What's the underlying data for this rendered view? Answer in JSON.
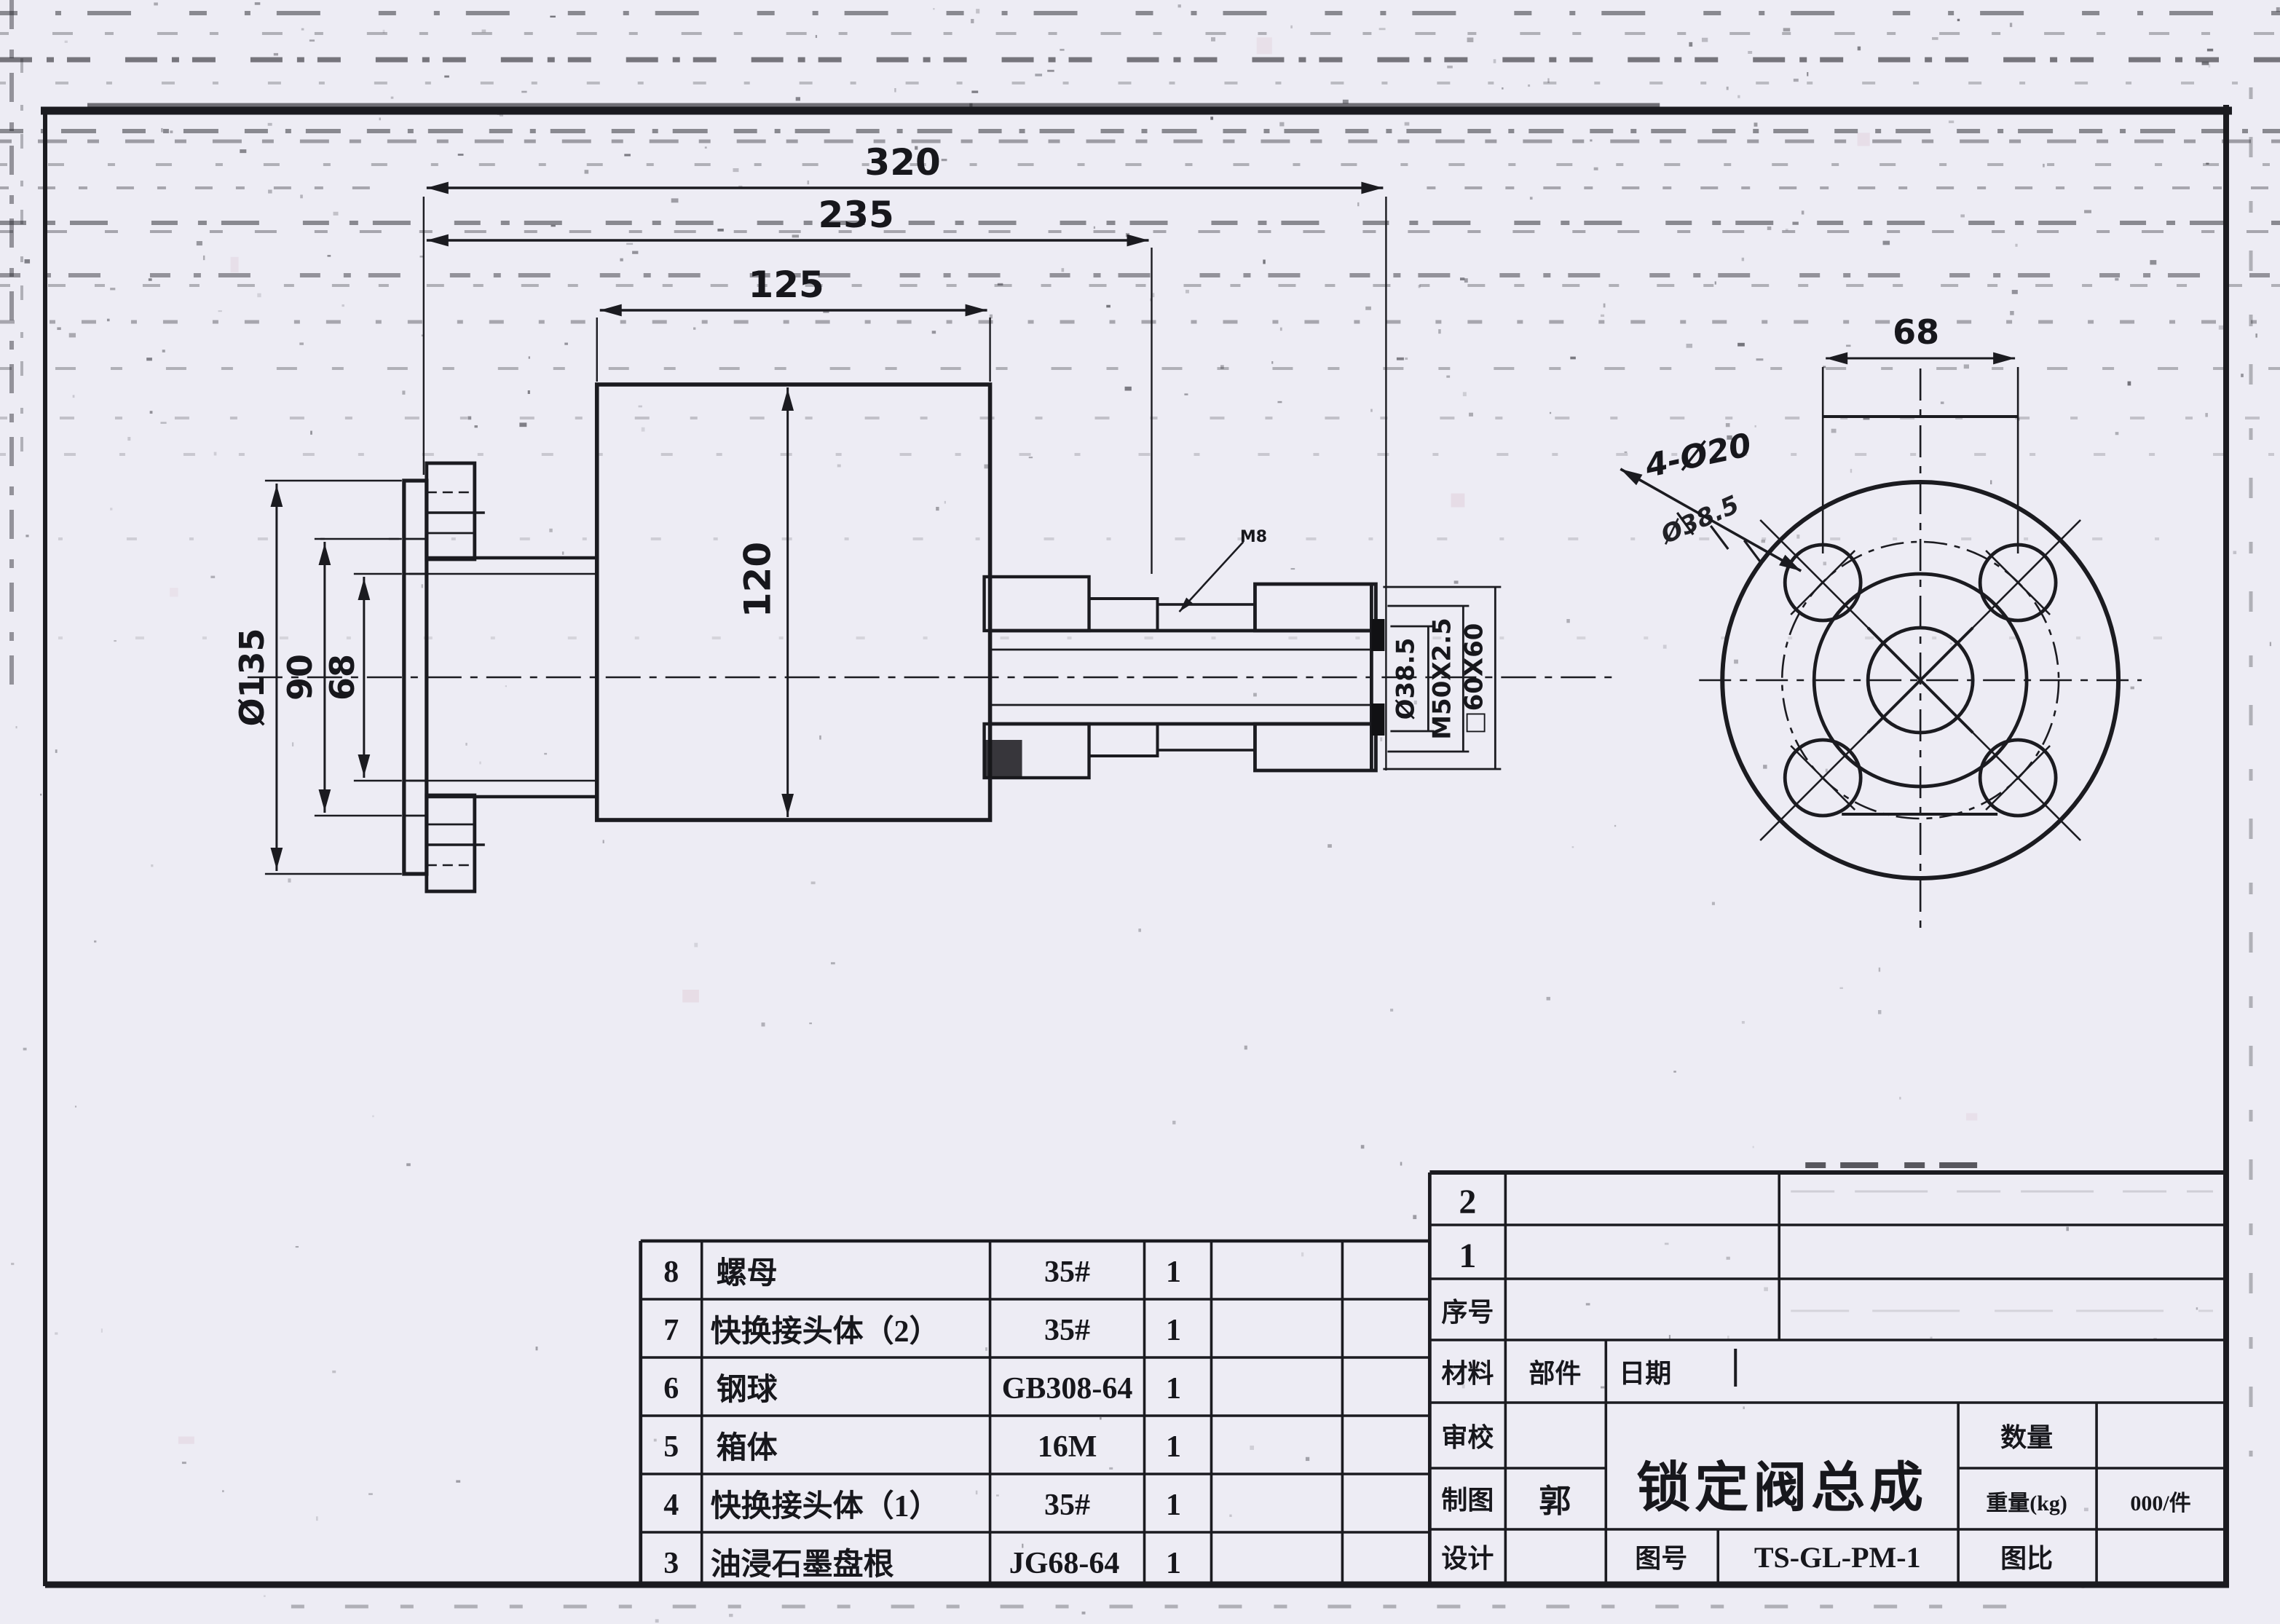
{
  "document": {
    "type": "scanned engineering drawing",
    "language": "zh-CN",
    "ink_color": "#1b1b20",
    "paper_color": "#edecf4"
  },
  "dims": {
    "len320": "320",
    "len235": "235",
    "len125": "125",
    "len120": "120",
    "dia135": "Ø135",
    "len90": "90",
    "len68_side": "68",
    "len68_flange": "68",
    "bore": "Ø38.5",
    "thread": "M50X2.5",
    "square": "□60X60",
    "holes_note": "4-Ø20",
    "crossed_out_note": "Ø38.5",
    "weld_note": "M8"
  },
  "parts_table": {
    "rows": [
      {
        "seq": "8",
        "name": "螺母",
        "material": "35#",
        "qty": "1"
      },
      {
        "seq": "7",
        "name": "快换接头体（2）",
        "material": "35#",
        "qty": "1"
      },
      {
        "seq": "6",
        "name": "钢球",
        "material": "GB308-64",
        "qty": "1"
      },
      {
        "seq": "5",
        "name": "箱体",
        "material": "16M",
        "qty": "1"
      },
      {
        "seq": "4",
        "name": "快换接头体（1）",
        "material": "35#",
        "qty": "1"
      },
      {
        "seq": "3",
        "name": "油浸石墨盘根",
        "material": "JG68-64",
        "qty": "1"
      }
    ]
  },
  "title_block": {
    "row2": "2",
    "row1": "1",
    "seq_label": "序号",
    "material_label": "材料",
    "part_label": "部件",
    "date_label": "日期",
    "check_label": "审校",
    "draft_label": "制图",
    "draft_value": "郭",
    "design_label": "设计",
    "title": "锁定阀总成",
    "qty_label": "数量",
    "weight_label": "重量(kg)",
    "weight_value": "000/件",
    "drawing_no_label": "图号",
    "drawing_no": "TS-GL-PM-1",
    "scale_label": "图比"
  }
}
